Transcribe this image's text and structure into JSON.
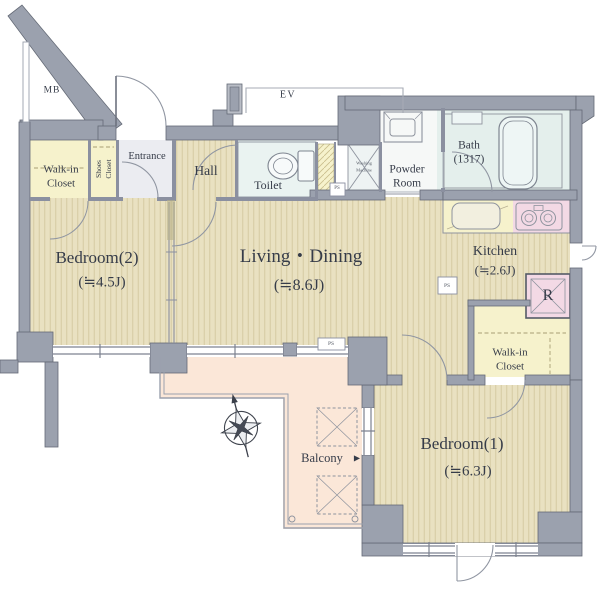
{
  "plan": {
    "title": "Apartment floor plan",
    "rooms": {
      "living_dining": {
        "label": "Living・Dining",
        "area": "(≒8.6J)"
      },
      "bedroom1": {
        "label": "Bedroom(1)",
        "area": "(≒6.3J)"
      },
      "bedroom2": {
        "label": "Bedroom(2)",
        "area": "(≒4.5J)"
      },
      "kitchen": {
        "label": "Kitchen",
        "area": "(≒2.6J)"
      },
      "hall": {
        "label": "Hall"
      },
      "entrance": {
        "label": "Entrance"
      },
      "toilet": {
        "label": "Toilet"
      },
      "powder_room": {
        "line1": "Powder",
        "line2": "Room"
      },
      "bath": {
        "label": "Bath",
        "size": "(1317)"
      },
      "walk_in_closet_left": {
        "line1": "Walk-in",
        "line2": "Closet"
      },
      "walk_in_closet_right": {
        "line1": "Walk-in",
        "line2": "Closet"
      },
      "shoes_closet": {
        "line1": "Shoes",
        "line2": "Closet"
      },
      "balcony": {
        "label": "Balcony",
        "arrow": "▶"
      },
      "washing_machine": {
        "line1": "Washing",
        "line2": "Machine"
      }
    },
    "annotations": {
      "mb": "MB",
      "ev": "EV",
      "refrigerator": "R",
      "ps": "PS"
    },
    "colors": {
      "wall": "#9ba1ae",
      "floor": "#e9e1c1",
      "floor_stripe": "#d5caa2",
      "closet_yellow": "#f6f2cc",
      "wet_cyan": "#e4efec",
      "entrance_gray": "#ebecf1",
      "pink": "#f3d9e5",
      "balcony_peach": "#fbe7d8"
    }
  }
}
